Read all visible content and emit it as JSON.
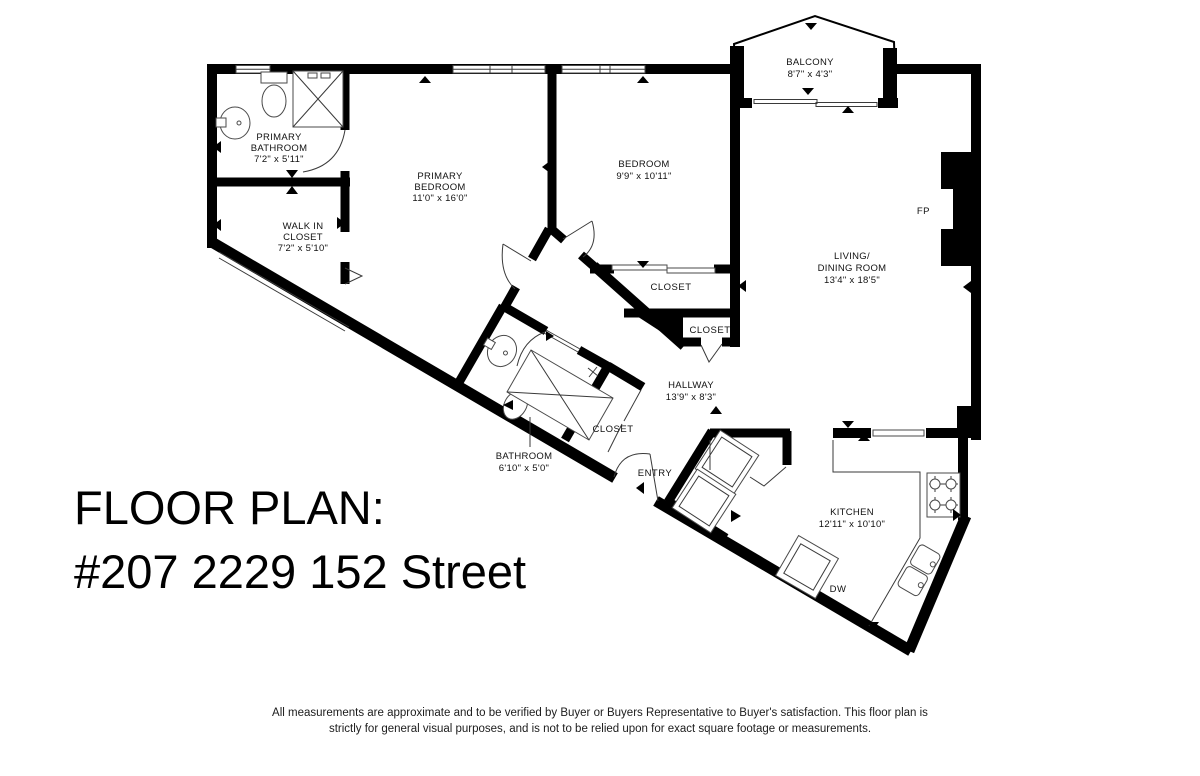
{
  "title": {
    "line1": "FLOOR PLAN:",
    "line2": "#207 2229 152 Street"
  },
  "disclaimer": {
    "line1": "All measurements are approximate and to be verified by Buyer or Buyers Representative to Buyer's satisfaction. This floor plan is",
    "line2": "strictly for general visual purposes, and is not to be relied upon for exact square footage or measurements."
  },
  "rooms": {
    "primary_bathroom": {
      "l1": "PRIMARY",
      "l2": "BATHROOM",
      "dims": "7'2\" x 5'11\""
    },
    "walk_in_closet": {
      "l1": "WALK IN",
      "l2": "CLOSET",
      "dims": "7'2\" x 5'10\""
    },
    "primary_bedroom": {
      "l1": "PRIMARY",
      "l2": "BEDROOM",
      "dims": "11'0\" x 16'0\""
    },
    "bedroom": {
      "l1": "BEDROOM",
      "dims": "9'9\" x 10'11\""
    },
    "balcony": {
      "l1": "BALCONY",
      "dims": "8'7\" x 4'3\""
    },
    "living_dining": {
      "l1": "LIVING/",
      "l2": "DINING ROOM",
      "dims": "13'4\" x 18'5\""
    },
    "hallway": {
      "l1": "HALLWAY",
      "dims": "13'9\" x 8'3\""
    },
    "bathroom": {
      "l1": "BATHROOM",
      "dims": "6'10\" x 5'0\""
    },
    "kitchen": {
      "l1": "KITCHEN",
      "dims": "12'11\" x 10'10\""
    },
    "closet_bedroom": "CLOSET",
    "closet_hall": "CLOSET",
    "closet_bath": "CLOSET",
    "entry": "ENTRY",
    "dishwasher": "DW",
    "fireplace": "FP"
  },
  "icons": {
    "fixtures": [
      "toilet-icon",
      "sink-icon",
      "shower-icon",
      "tub-icon",
      "stove-icon",
      "kitchen-sink-icon",
      "dishwasher-icon",
      "washer-icon",
      "dryer-icon",
      "fireplace-icon"
    ]
  },
  "colors": {
    "wall": "#000000",
    "background": "#ffffff",
    "thin_line": "#3a3a3a"
  }
}
